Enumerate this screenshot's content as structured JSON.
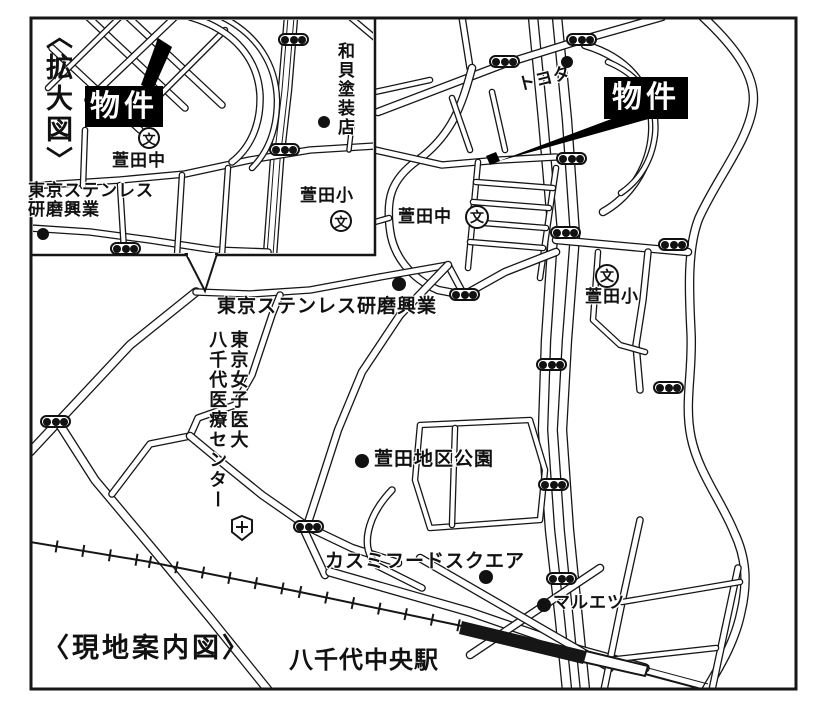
{
  "title": "〈現地案内図〉",
  "inset": {
    "title": "〈拡大図〉"
  },
  "colors": {
    "ink": "#161616",
    "paper": "#ffffff",
    "property_bg": "#000000",
    "property_text": "#ffffff"
  },
  "labels": [
    {
      "name": "label-property-inset",
      "text": "物件",
      "x": 85,
      "y": 86,
      "size": 30,
      "box": {
        "w": 78,
        "h": 41
      }
    },
    {
      "name": "label-kayada-junior-high-inset",
      "text": "萱田中",
      "x": 112,
      "y": 151,
      "size": 17
    },
    {
      "name": "label-tokyo-stainless-inset",
      "text": "東京ステンレス\n研磨興業",
      "x": 28,
      "y": 181,
      "size": 17
    },
    {
      "name": "label-wakai-paint-shop",
      "text": "和貝塗装店",
      "x": 334,
      "y": 42,
      "size": 17,
      "vertical": true
    },
    {
      "name": "label-kayada-elementary-inset",
      "text": "萱田小",
      "x": 300,
      "y": 186,
      "size": 17
    },
    {
      "name": "label-toyota",
      "text": "トヨタ",
      "x": 516,
      "y": 76,
      "size": 17,
      "rot": -14
    },
    {
      "name": "label-property-main",
      "text": "物件",
      "x": 604,
      "y": 77,
      "size": 30,
      "box": {
        "w": 84,
        "h": 42
      }
    },
    {
      "name": "label-kayada-junior-high",
      "text": "萱田中",
      "x": 398,
      "y": 207,
      "size": 17
    },
    {
      "name": "label-kayada-elementary",
      "text": "萱田小",
      "x": 585,
      "y": 287,
      "size": 17
    },
    {
      "name": "label-tokyo-stainless",
      "text": "東京ステンレス研磨興業",
      "x": 217,
      "y": 296,
      "size": 19
    },
    {
      "name": "label-yachiyo-medical-center",
      "text": "東京女子医大\n八千代医療センター",
      "x": 206,
      "y": 330,
      "size": 18,
      "vertical": true
    },
    {
      "name": "label-kayada-district-park",
      "text": "萱田地区公園",
      "x": 374,
      "y": 449,
      "size": 19
    },
    {
      "name": "label-kasumi-food-square",
      "text": "カスミフードスクエア",
      "x": 325,
      "y": 551,
      "size": 19
    },
    {
      "name": "label-maruetsu",
      "text": "マルエツ",
      "x": 553,
      "y": 593,
      "size": 17
    },
    {
      "name": "label-yachiyo-chuo-station",
      "text": "八千代中央駅",
      "x": 289,
      "y": 648,
      "size": 24
    }
  ],
  "markers": {
    "dots": [
      {
        "name": "dot-tokyo-stainless-inset",
        "x": 43,
        "y": 234,
        "r": 6
      },
      {
        "name": "dot-wakai-paint-shop",
        "x": 324,
        "y": 122,
        "r": 6
      },
      {
        "name": "dot-toyota",
        "x": 567,
        "y": 62,
        "r": 6
      },
      {
        "name": "dot-tokyo-stainless",
        "x": 399,
        "y": 284,
        "r": 7
      },
      {
        "name": "dot-kayada-district-park",
        "x": 362,
        "y": 461,
        "r": 7
      },
      {
        "name": "dot-kasumi-food-square",
        "x": 486,
        "y": 577,
        "r": 7
      },
      {
        "name": "dot-maruetsu",
        "x": 544,
        "y": 605,
        "r": 7
      }
    ],
    "schools": [
      {
        "name": "school-icon-kayada-junior-high-inset",
        "symbol": "文",
        "x": 149,
        "y": 138,
        "r": 11
      },
      {
        "name": "school-icon-kayada-elementary-inset",
        "symbol": "文",
        "x": 341,
        "y": 221,
        "r": 11
      },
      {
        "name": "school-icon-kayada-junior-high",
        "symbol": "文",
        "x": 477,
        "y": 217,
        "r": 12
      },
      {
        "name": "school-icon-kayada-elementary",
        "symbol": "文",
        "x": 607,
        "y": 276,
        "r": 12
      }
    ],
    "traffic_lights": [
      {
        "x": 293,
        "y": 40
      },
      {
        "x": 284,
        "y": 150
      },
      {
        "x": 125,
        "y": 249
      },
      {
        "x": 581,
        "y": 40
      },
      {
        "x": 504,
        "y": 62
      },
      {
        "x": 571,
        "y": 159
      },
      {
        "x": 565,
        "y": 233
      },
      {
        "x": 673,
        "y": 245
      },
      {
        "x": 464,
        "y": 295
      },
      {
        "x": 551,
        "y": 365
      },
      {
        "x": 668,
        "y": 388
      },
      {
        "x": 553,
        "y": 485
      },
      {
        "x": 308,
        "y": 527
      },
      {
        "x": 561,
        "y": 579
      },
      {
        "x": 55,
        "y": 422
      }
    ],
    "hospital_icon": {
      "x": 242,
      "y": 516
    }
  }
}
